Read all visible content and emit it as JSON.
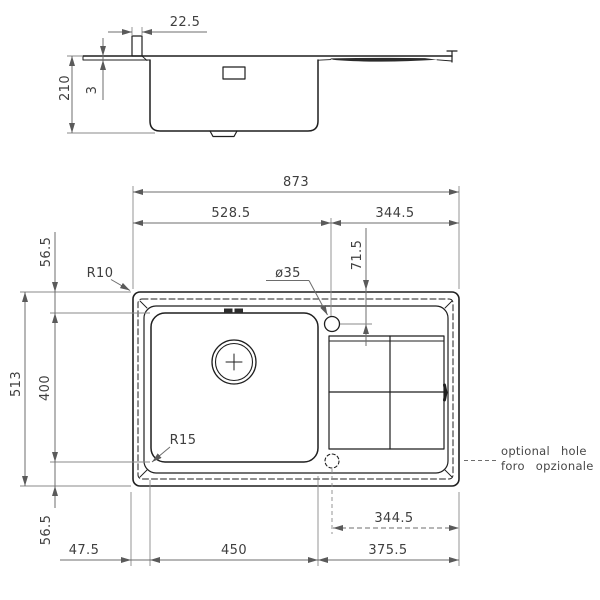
{
  "drawing": {
    "kind": "kitchen sink installation drawing (front section and plan view)",
    "colors": {
      "outline": "#1f1f1f",
      "dimension_lines": "#6d6d6d",
      "dimension_text": "#3f3f3f",
      "background": "#ffffff"
    },
    "side_view": {
      "ledge_width": "22.5",
      "overall_depth": "210",
      "rim_height": "3"
    },
    "plan_view": {
      "overall_width": "873",
      "left_span": "528.5",
      "right_span": "344.5",
      "tap_hole_offset": "71.5",
      "tap_hole_diameter": "ø35",
      "outer_corner_radius": "R10",
      "bowl_corner_radius": "R15",
      "overall_depth": "513",
      "bowl_depth": "400",
      "top_margin": "56.5",
      "bottom_margin": "56.5",
      "left_margin": "47.5",
      "bowl_width": "450",
      "drainer_span": "375.5",
      "optional_hole_offset": "344.5"
    },
    "notes": {
      "optional_hole_en": "optional hole",
      "optional_hole_it": "foro opzionale"
    }
  }
}
